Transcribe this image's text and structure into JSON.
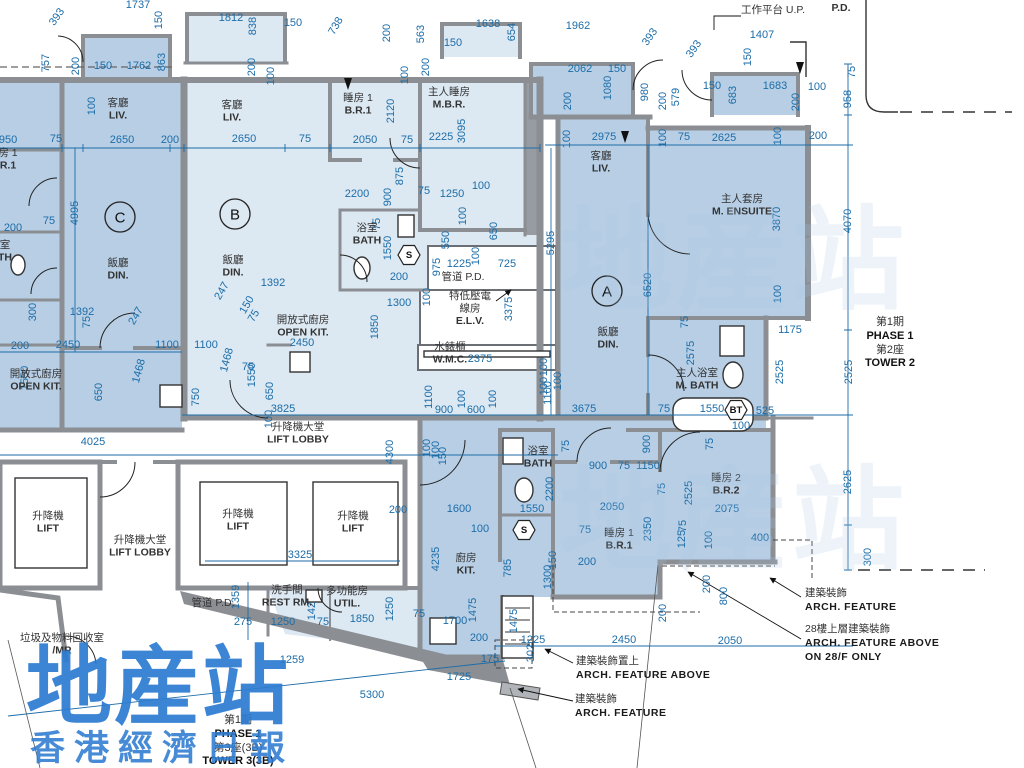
{
  "colors": {
    "unit_dark": "#b7cee5",
    "unit_light": "#dce8f2",
    "wall": "#8b8e93",
    "dim": "#1c6da8",
    "watermark": "#2e7cd1",
    "room_text": "#333333"
  },
  "watermark": {
    "main": "地産站",
    "sub": "香港經濟日報"
  },
  "phase_right": {
    "lines": [
      "第1期",
      "PHASE 1",
      "第2座",
      "TOWER 2"
    ]
  },
  "phase_bottom": {
    "lines": [
      "第1期",
      "PHASE 1",
      "第3座(3B)",
      "TOWER 3(3B)"
    ]
  },
  "units": [
    {
      "label": "C",
      "x": 120,
      "y": 217
    },
    {
      "label": "B",
      "x": 235,
      "y": 214
    },
    {
      "label": "A",
      "x": 607,
      "y": 291
    }
  ],
  "symbols": [
    {
      "label": "S",
      "x": 409,
      "y": 255
    },
    {
      "label": "S",
      "x": 524,
      "y": 530
    },
    {
      "label": "BT",
      "x": 736,
      "y": 410
    }
  ],
  "rooms": [
    {
      "lines": [
        "客廳",
        "LIV."
      ],
      "x": 118,
      "y": 103
    },
    {
      "lines": [
        "飯廳",
        "DIN."
      ],
      "x": 118,
      "y": 263
    },
    {
      "lines": [
        "客廳",
        "LIV."
      ],
      "x": 232,
      "y": 105
    },
    {
      "lines": [
        "飯廳",
        "DIN."
      ],
      "x": 233,
      "y": 260
    },
    {
      "lines": [
        "睡房 1",
        "B.R.1"
      ],
      "x": 358,
      "y": 98
    },
    {
      "lines": [
        "主人睡房",
        "M.B.R."
      ],
      "x": 449,
      "y": 92
    },
    {
      "lines": [
        "浴室",
        "BATH"
      ],
      "x": 367,
      "y": 228
    },
    {
      "lines": [
        "管道 P.D."
      ],
      "x": 463,
      "y": 277
    },
    {
      "lines": [
        "特低壓電",
        "線房",
        "E.L.V."
      ],
      "x": 470,
      "y": 296
    },
    {
      "lines": [
        "水錶櫃",
        "W.M.C."
      ],
      "x": 450,
      "y": 347
    },
    {
      "lines": [
        "客廳",
        "LIV."
      ],
      "x": 601,
      "y": 156
    },
    {
      "lines": [
        "飯廳",
        "DIN."
      ],
      "x": 608,
      "y": 332
    },
    {
      "lines": [
        "主人套房",
        "M. ENSUITE"
      ],
      "x": 742,
      "y": 199
    },
    {
      "lines": [
        "主人浴室",
        "M. BATH"
      ],
      "x": 697,
      "y": 373
    },
    {
      "lines": [
        "睡房 2",
        "B.R.2"
      ],
      "x": 726,
      "y": 478
    },
    {
      "lines": [
        "睡房 1",
        "B.R.1"
      ],
      "x": 619,
      "y": 533
    },
    {
      "lines": [
        "浴室",
        "BATH"
      ],
      "x": 538,
      "y": 451
    },
    {
      "lines": [
        "廚房",
        "KIT."
      ],
      "x": 466,
      "y": 558
    },
    {
      "lines": [
        "開放式廚房",
        "OPEN KIT."
      ],
      "x": 36,
      "y": 374
    },
    {
      "lines": [
        "開放式廚房",
        "OPEN KIT."
      ],
      "x": 303,
      "y": 320
    },
    {
      "lines": [
        "升降機",
        "LIFT"
      ],
      "x": 48,
      "y": 516
    },
    {
      "lines": [
        "升降機",
        "LIFT"
      ],
      "x": 238,
      "y": 514
    },
    {
      "lines": [
        "升降機",
        "LIFT"
      ],
      "x": 353,
      "y": 516
    },
    {
      "lines": [
        "升降機大堂",
        "LIFT LOBBY"
      ],
      "x": 298,
      "y": 427
    },
    {
      "lines": [
        "升降機大堂",
        "LIFT LOBBY"
      ],
      "x": 140,
      "y": 540
    },
    {
      "lines": [
        "管道 P.D."
      ],
      "x": 213,
      "y": 603
    },
    {
      "lines": [
        "洗手間",
        "REST RM."
      ],
      "x": 287,
      "y": 590
    },
    {
      "lines": [
        "多功能房",
        "UTIL."
      ],
      "x": 347,
      "y": 591
    },
    {
      "lines": [
        "垃圾及物料回收室",
        "/MR"
      ],
      "x": 62,
      "y": 638
    },
    {
      "lines": [
        "工作平台 U.P."
      ],
      "x": 773,
      "y": 10
    },
    {
      "lines": [
        "P.D."
      ],
      "x": 841,
      "y": 8
    },
    {
      "lines": [
        "房 1",
        "R.1"
      ],
      "x": 8,
      "y": 153
    },
    {
      "lines": [
        "室",
        "TH"
      ],
      "x": 5,
      "y": 245
    }
  ],
  "annotations": [
    {
      "lines": [
        "建築裝飾置上",
        "ARCH. FEATURE ABOVE"
      ],
      "x": 576,
      "y": 655
    },
    {
      "lines": [
        "建築裝飾",
        "ARCH. FEATURE"
      ],
      "x": 575,
      "y": 693
    },
    {
      "lines": [
        "建築裝飾",
        "ARCH. FEATURE"
      ],
      "x": 805,
      "y": 587
    },
    {
      "lines": [
        "28樓上層建築裝飾",
        "ARCH. FEATURE ABOVE",
        "ON 28/F ONLY"
      ],
      "x": 805,
      "y": 623
    }
  ],
  "dims": [
    {
      "v": "393",
      "x": 57,
      "y": 17,
      "r": -55
    },
    {
      "v": "1737",
      "x": 138,
      "y": 5
    },
    {
      "v": "757",
      "x": 46,
      "y": 63,
      "r": -90
    },
    {
      "v": "200",
      "x": 76,
      "y": 66,
      "r": -90
    },
    {
      "v": "150",
      "x": 103,
      "y": 66
    },
    {
      "v": "1762",
      "x": 139,
      "y": 66
    },
    {
      "v": "863",
      "x": 162,
      "y": 62,
      "r": -90
    },
    {
      "v": "150",
      "x": 159,
      "y": 20,
      "r": -90
    },
    {
      "v": "1812",
      "x": 231,
      "y": 18
    },
    {
      "v": "838",
      "x": 253,
      "y": 26,
      "r": -90
    },
    {
      "v": "150",
      "x": 293,
      "y": 23
    },
    {
      "v": "738",
      "x": 336,
      "y": 26,
      "r": -60
    },
    {
      "v": "200",
      "x": 252,
      "y": 67,
      "r": -90
    },
    {
      "v": "100",
      "x": 271,
      "y": 76,
      "r": -90
    },
    {
      "v": "100",
      "x": 92,
      "y": 106,
      "r": -90
    },
    {
      "v": "950",
      "x": 8,
      "y": 140
    },
    {
      "v": "75",
      "x": 56,
      "y": 139
    },
    {
      "v": "2650",
      "x": 122,
      "y": 140
    },
    {
      "v": "200",
      "x": 170,
      "y": 140
    },
    {
      "v": "4995",
      "x": 75,
      "y": 213,
      "r": -90
    },
    {
      "v": "75",
      "x": 49,
      "y": 221
    },
    {
      "v": "200",
      "x": 13,
      "y": 228
    },
    {
      "v": "300",
      "x": 33,
      "y": 312,
      "r": -90
    },
    {
      "v": "1392",
      "x": 82,
      "y": 312
    },
    {
      "v": "1392",
      "x": 273,
      "y": 283
    },
    {
      "v": "247",
      "x": 136,
      "y": 316,
      "r": -60
    },
    {
      "v": "247",
      "x": 222,
      "y": 291,
      "r": -60
    },
    {
      "v": "150",
      "x": 247,
      "y": 305,
      "r": -60
    },
    {
      "v": "75",
      "x": 254,
      "y": 316,
      "r": -60
    },
    {
      "v": "75",
      "x": 87,
      "y": 322,
      "r": -90
    },
    {
      "v": "200",
      "x": 20,
      "y": 346
    },
    {
      "v": "2450",
      "x": 68,
      "y": 345
    },
    {
      "v": "1100",
      "x": 167,
      "y": 345
    },
    {
      "v": "1100",
      "x": 206,
      "y": 345
    },
    {
      "v": "1468",
      "x": 139,
      "y": 371,
      "r": -75
    },
    {
      "v": "1468",
      "x": 227,
      "y": 360,
      "r": -75
    },
    {
      "v": "1550",
      "x": 25,
      "y": 378,
      "r": -90
    },
    {
      "v": "650",
      "x": 99,
      "y": 392,
      "r": -90
    },
    {
      "v": "1550",
      "x": 252,
      "y": 375,
      "r": -90
    },
    {
      "v": "650",
      "x": 270,
      "y": 391,
      "r": -90
    },
    {
      "v": "75",
      "x": 248,
      "y": 367
    },
    {
      "v": "2450",
      "x": 302,
      "y": 343
    },
    {
      "v": "100",
      "x": 269,
      "y": 419,
      "r": -90
    },
    {
      "v": "3825",
      "x": 283,
      "y": 409
    },
    {
      "v": "750",
      "x": 196,
      "y": 397,
      "r": -90
    },
    {
      "v": "4025",
      "x": 93,
      "y": 442
    },
    {
      "v": "2650",
      "x": 244,
      "y": 139
    },
    {
      "v": "75",
      "x": 305,
      "y": 139
    },
    {
      "v": "2050",
      "x": 365,
      "y": 140
    },
    {
      "v": "75",
      "x": 407,
      "y": 140
    },
    {
      "v": "2120",
      "x": 391,
      "y": 111,
      "r": -90
    },
    {
      "v": "100",
      "x": 405,
      "y": 75,
      "r": -90
    },
    {
      "v": "200",
      "x": 426,
      "y": 67,
      "r": -90
    },
    {
      "v": "1638",
      "x": 488,
      "y": 24
    },
    {
      "v": "150",
      "x": 453,
      "y": 43
    },
    {
      "v": "654",
      "x": 512,
      "y": 32,
      "r": -90
    },
    {
      "v": "563",
      "x": 421,
      "y": 34,
      "r": -90
    },
    {
      "v": "200",
      "x": 387,
      "y": 33,
      "r": -90
    },
    {
      "v": "1962",
      "x": 578,
      "y": 26
    },
    {
      "v": "393",
      "x": 650,
      "y": 37,
      "r": -55
    },
    {
      "v": "393",
      "x": 694,
      "y": 49,
      "r": -55
    },
    {
      "v": "2225",
      "x": 441,
      "y": 137
    },
    {
      "v": "3095",
      "x": 462,
      "y": 131,
      "r": -90
    },
    {
      "v": "2062",
      "x": 580,
      "y": 69
    },
    {
      "v": "150",
      "x": 617,
      "y": 69
    },
    {
      "v": "980",
      "x": 645,
      "y": 92,
      "r": -90
    },
    {
      "v": "200",
      "x": 663,
      "y": 101,
      "r": -90
    },
    {
      "v": "579",
      "x": 676,
      "y": 97,
      "r": -90
    },
    {
      "v": "1080",
      "x": 608,
      "y": 88,
      "r": -90
    },
    {
      "v": "200",
      "x": 568,
      "y": 101,
      "r": -90
    },
    {
      "v": "100",
      "x": 567,
      "y": 139,
      "r": -90
    },
    {
      "v": "2975",
      "x": 604,
      "y": 137
    },
    {
      "v": "100",
      "x": 663,
      "y": 138,
      "r": -90
    },
    {
      "v": "75",
      "x": 684,
      "y": 137
    },
    {
      "v": "2625",
      "x": 724,
      "y": 138
    },
    {
      "v": "100",
      "x": 778,
      "y": 136,
      "r": -90
    },
    {
      "v": "200",
      "x": 818,
      "y": 136
    },
    {
      "v": "150",
      "x": 712,
      "y": 86
    },
    {
      "v": "1683",
      "x": 775,
      "y": 86
    },
    {
      "v": "100",
      "x": 817,
      "y": 87
    },
    {
      "v": "683",
      "x": 733,
      "y": 95,
      "r": -90
    },
    {
      "v": "200",
      "x": 796,
      "y": 102,
      "r": -90
    },
    {
      "v": "1407",
      "x": 762,
      "y": 35
    },
    {
      "v": "150",
      "x": 748,
      "y": 57,
      "r": -90
    },
    {
      "v": "75",
      "x": 852,
      "y": 72,
      "r": -90
    },
    {
      "v": "958",
      "x": 848,
      "y": 99,
      "r": -90
    },
    {
      "v": "4070",
      "x": 848,
      "y": 221,
      "r": -90
    },
    {
      "v": "2525",
      "x": 849,
      "y": 372,
      "r": -90
    },
    {
      "v": "2625",
      "x": 848,
      "y": 482,
      "r": -90
    },
    {
      "v": "300",
      "x": 868,
      "y": 557,
      "r": -90
    },
    {
      "v": "5295",
      "x": 551,
      "y": 243,
      "r": -90
    },
    {
      "v": "6520",
      "x": 648,
      "y": 285,
      "r": -90
    },
    {
      "v": "3870",
      "x": 777,
      "y": 219,
      "r": -90
    },
    {
      "v": "100",
      "x": 778,
      "y": 294,
      "r": -90
    },
    {
      "v": "1175",
      "x": 790,
      "y": 330
    },
    {
      "v": "2525",
      "x": 780,
      "y": 372,
      "r": -90
    },
    {
      "v": "2575",
      "x": 691,
      "y": 353,
      "r": -90
    },
    {
      "v": "75",
      "x": 685,
      "y": 322,
      "r": -90
    },
    {
      "v": "2200",
      "x": 357,
      "y": 194
    },
    {
      "v": "75",
      "x": 424,
      "y": 191
    },
    {
      "v": "1250",
      "x": 452,
      "y": 194
    },
    {
      "v": "100",
      "x": 481,
      "y": 186
    },
    {
      "v": "900",
      "x": 388,
      "y": 197,
      "r": -90
    },
    {
      "v": "875",
      "x": 400,
      "y": 176,
      "r": -90
    },
    {
      "v": "75",
      "x": 377,
      "y": 224,
      "r": -90
    },
    {
      "v": "1550",
      "x": 388,
      "y": 248,
      "r": -90
    },
    {
      "v": "100",
      "x": 463,
      "y": 216,
      "r": -90
    },
    {
      "v": "550",
      "x": 446,
      "y": 240,
      "r": -90
    },
    {
      "v": "650",
      "x": 494,
      "y": 231,
      "r": -90
    },
    {
      "v": "100",
      "x": 476,
      "y": 256,
      "r": -90
    },
    {
      "v": "200",
      "x": 399,
      "y": 277
    },
    {
      "v": "975",
      "x": 437,
      "y": 267,
      "r": -90
    },
    {
      "v": "1225",
      "x": 459,
      "y": 264
    },
    {
      "v": "725",
      "x": 507,
      "y": 264
    },
    {
      "v": "100",
      "x": 427,
      "y": 297,
      "r": -90
    },
    {
      "v": "1300",
      "x": 399,
      "y": 303
    },
    {
      "v": "3375",
      "x": 509,
      "y": 309,
      "r": -90
    },
    {
      "v": "1850",
      "x": 375,
      "y": 327,
      "r": -90
    },
    {
      "v": "2375",
      "x": 480,
      "y": 359
    },
    {
      "v": "100",
      "x": 544,
      "y": 367,
      "r": -90
    },
    {
      "v": "100",
      "x": 544,
      "y": 386,
      "r": -90
    },
    {
      "v": "1100",
      "x": 429,
      "y": 397,
      "r": -90
    },
    {
      "v": "900",
      "x": 444,
      "y": 410
    },
    {
      "v": "100",
      "x": 462,
      "y": 399,
      "r": -90
    },
    {
      "v": "600",
      "x": 476,
      "y": 410
    },
    {
      "v": "100",
      "x": 493,
      "y": 399,
      "r": -90
    },
    {
      "v": "1100",
      "x": 548,
      "y": 393,
      "r": -90
    },
    {
      "v": "100",
      "x": 558,
      "y": 381,
      "r": -90
    },
    {
      "v": "3675",
      "x": 584,
      "y": 409
    },
    {
      "v": "75",
      "x": 664,
      "y": 409
    },
    {
      "v": "1550",
      "x": 712,
      "y": 409
    },
    {
      "v": "525",
      "x": 765,
      "y": 411
    },
    {
      "v": "100",
      "x": 741,
      "y": 426
    },
    {
      "v": "900",
      "x": 598,
      "y": 466
    },
    {
      "v": "75",
      "x": 624,
      "y": 466
    },
    {
      "v": "1150",
      "x": 648,
      "y": 466
    },
    {
      "v": "900",
      "x": 647,
      "y": 444,
      "r": -90
    },
    {
      "v": "75",
      "x": 566,
      "y": 446,
      "r": -90
    },
    {
      "v": "2200",
      "x": 550,
      "y": 489,
      "r": -90
    },
    {
      "v": "2050",
      "x": 612,
      "y": 507
    },
    {
      "v": "75",
      "x": 662,
      "y": 489,
      "r": -90
    },
    {
      "v": "2525",
      "x": 689,
      "y": 493,
      "r": -90
    },
    {
      "v": "75",
      "x": 710,
      "y": 444,
      "r": -90
    },
    {
      "v": "2075",
      "x": 727,
      "y": 509
    },
    {
      "v": "400",
      "x": 760,
      "y": 538
    },
    {
      "v": "75",
      "x": 683,
      "y": 526,
      "r": -90
    },
    {
      "v": "125",
      "x": 682,
      "y": 539,
      "r": -90
    },
    {
      "v": "100",
      "x": 709,
      "y": 540,
      "r": -90
    },
    {
      "v": "2350",
      "x": 648,
      "y": 529,
      "r": -90
    },
    {
      "v": "75",
      "x": 585,
      "y": 530
    },
    {
      "v": "200",
      "x": 587,
      "y": 562
    },
    {
      "v": "150",
      "x": 553,
      "y": 560,
      "r": -90
    },
    {
      "v": "1300",
      "x": 548,
      "y": 577,
      "r": -90
    },
    {
      "v": "200",
      "x": 663,
      "y": 613,
      "r": -90
    },
    {
      "v": "200",
      "x": 707,
      "y": 584,
      "r": -90
    },
    {
      "v": "800",
      "x": 724,
      "y": 596,
      "r": -90
    },
    {
      "v": "2450",
      "x": 624,
      "y": 640
    },
    {
      "v": "2050",
      "x": 730,
      "y": 641
    },
    {
      "v": "1225",
      "x": 533,
      "y": 640
    },
    {
      "v": "1600",
      "x": 459,
      "y": 509
    },
    {
      "v": "100",
      "x": 480,
      "y": 529
    },
    {
      "v": "4235",
      "x": 436,
      "y": 559,
      "r": -90
    },
    {
      "v": "1550",
      "x": 532,
      "y": 509
    },
    {
      "v": "785",
      "x": 508,
      "y": 568,
      "r": -90
    },
    {
      "v": "4300",
      "x": 390,
      "y": 452,
      "r": -90
    },
    {
      "v": "200",
      "x": 398,
      "y": 510
    },
    {
      "v": "1700",
      "x": 455,
      "y": 621
    },
    {
      "v": "1475",
      "x": 473,
      "y": 610,
      "r": -90
    },
    {
      "v": "1475",
      "x": 514,
      "y": 621,
      "r": -90
    },
    {
      "v": "200",
      "x": 479,
      "y": 638
    },
    {
      "v": "175",
      "x": 490,
      "y": 659
    },
    {
      "v": "302",
      "x": 531,
      "y": 653,
      "r": -90
    },
    {
      "v": "1725",
      "x": 459,
      "y": 677
    },
    {
      "v": "5300",
      "x": 372,
      "y": 695
    },
    {
      "v": "1259",
      "x": 292,
      "y": 660
    },
    {
      "v": "275",
      "x": 243,
      "y": 622
    },
    {
      "v": "1359",
      "x": 236,
      "y": 597,
      "r": -90
    },
    {
      "v": "3325",
      "x": 300,
      "y": 555
    },
    {
      "v": "1250",
      "x": 283,
      "y": 622
    },
    {
      "v": "75",
      "x": 323,
      "y": 622
    },
    {
      "v": "1850",
      "x": 362,
      "y": 619
    },
    {
      "v": "1250",
      "x": 390,
      "y": 609,
      "r": -90
    },
    {
      "v": "75",
      "x": 419,
      "y": 614
    },
    {
      "v": "142",
      "x": 312,
      "y": 611,
      "r": -90
    },
    {
      "v": "100",
      "x": 427,
      "y": 448,
      "r": -90
    },
    {
      "v": "100",
      "x": 436,
      "y": 450,
      "r": -90
    },
    {
      "v": "150",
      "x": 443,
      "y": 456,
      "r": -90
    }
  ]
}
